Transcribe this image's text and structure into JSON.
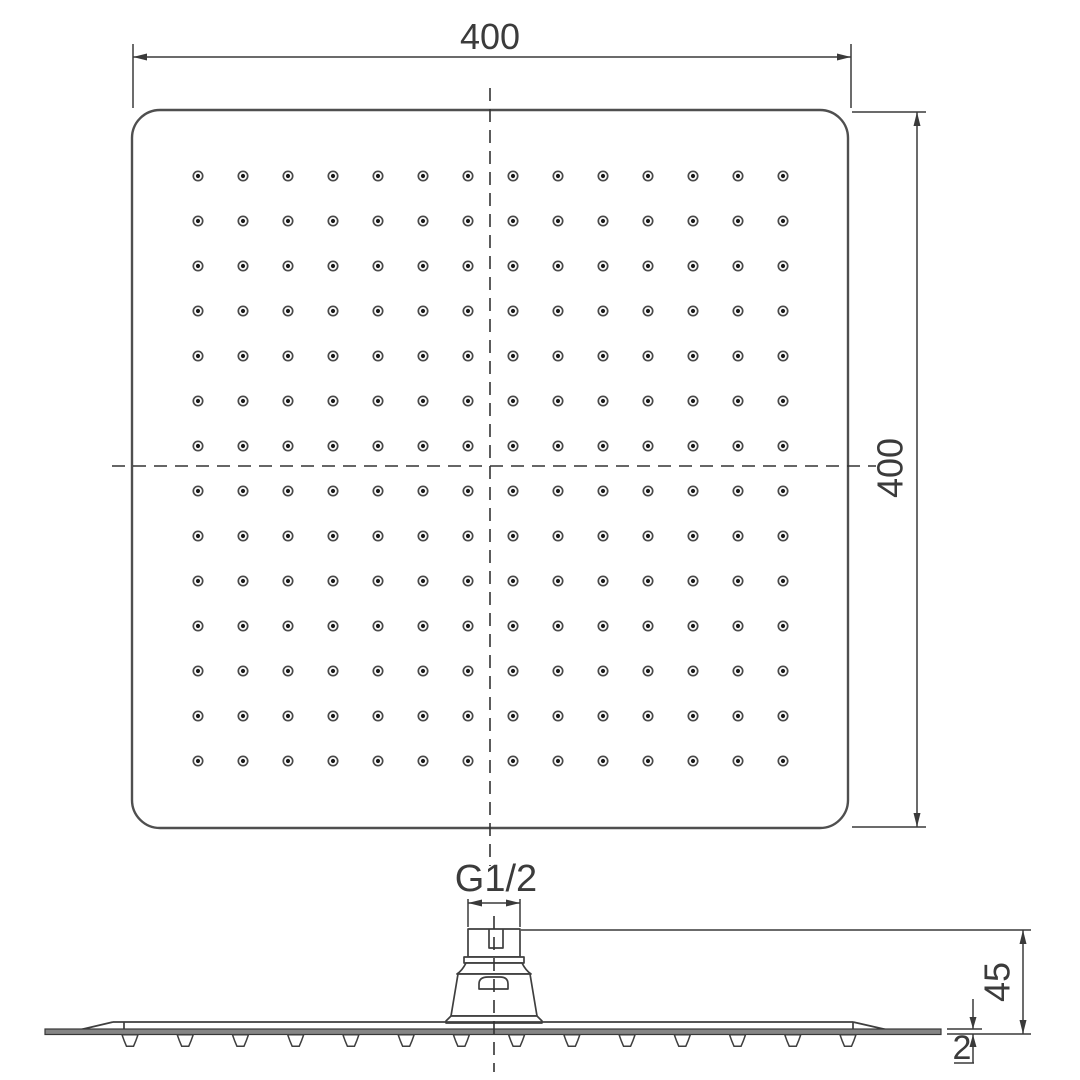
{
  "dimensions": {
    "top_width_label": "400",
    "right_height_label": "400",
    "thread_label": "G1/2",
    "head_height_label": "45",
    "plate_thickness_label": "2"
  },
  "top_view": {
    "nozzle_rows": 14,
    "nozzle_cols": 14
  },
  "side_view": {
    "bump_count": 14
  },
  "colors": {
    "line": "#3f3f3f",
    "outline": "#4f4f4f",
    "dash": "#333333",
    "text": "#3b3b3b",
    "nozzle_ring": "#4a4a4a",
    "nozzle_dot": "#1a1a1a",
    "plate_fill": "#858585",
    "background": "#ffffff"
  }
}
